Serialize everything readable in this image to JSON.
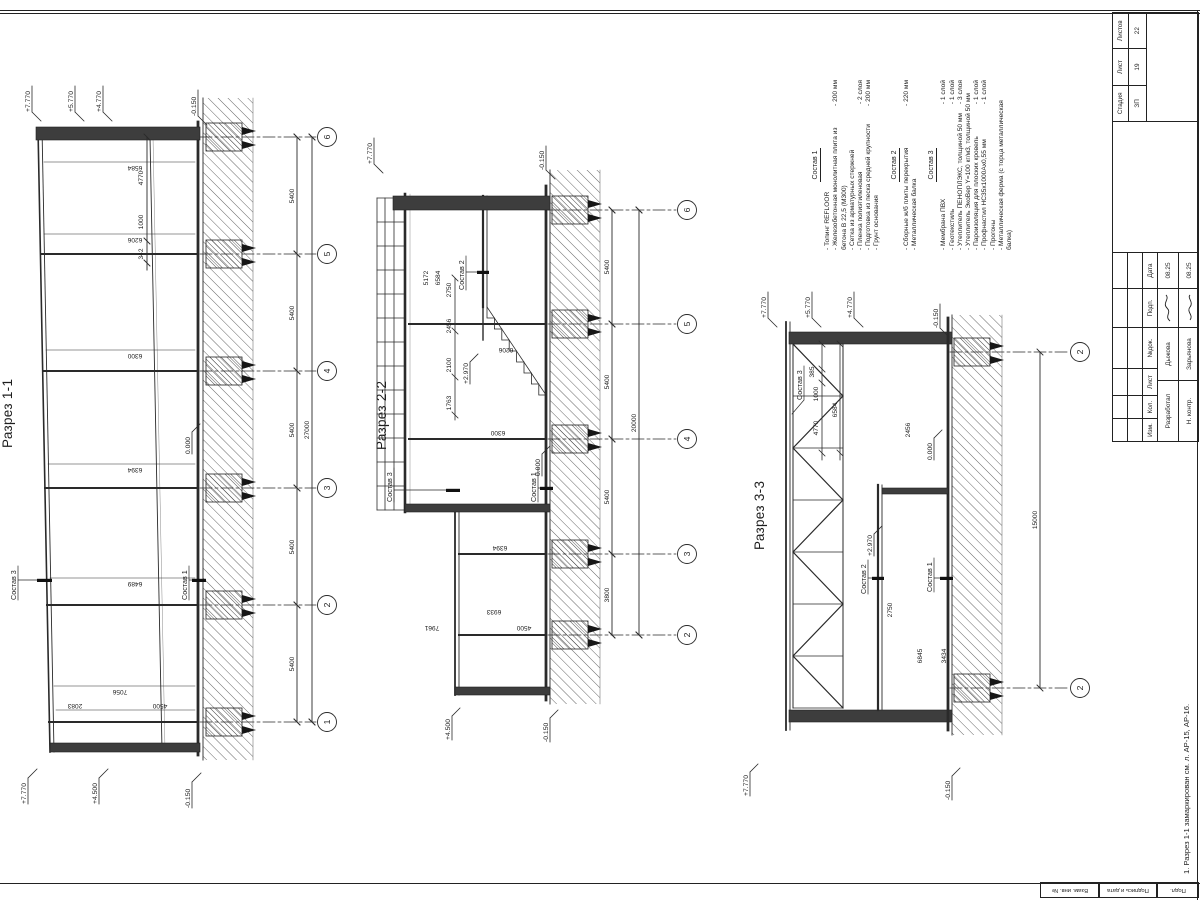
{
  "sections": {
    "s1": {
      "title": "Разрез 1-1",
      "axes": [
        "1",
        "2",
        "3",
        "4",
        "5",
        "6"
      ],
      "bay_dims": [
        "5400",
        "5400",
        "5400",
        "5400",
        "5400"
      ],
      "total_dim": "27000",
      "height_dims": [
        "2083",
        "4500",
        "7056",
        "6489",
        "6394",
        "6300",
        "6206",
        "6584"
      ],
      "top_dims": [
        "342",
        "1000",
        "4770"
      ],
      "elev": {
        "r1": "+7.770",
        "r2": "+5.770",
        "r3": "+4.770",
        "l1": "+7.770",
        "l2": "+4.500",
        "grade_r": "-0.150",
        "grade_l": "-0.150",
        "floor": "0.000"
      },
      "labels": {
        "roof": "Состав 3",
        "floor": "Состав 1"
      }
    },
    "s2": {
      "title": "Разрез 2-2",
      "axes": [
        "2",
        "3",
        "4",
        "5",
        "6"
      ],
      "bay_dims": [
        "3800",
        "5400",
        "5400",
        "5400"
      ],
      "total_dim": "20000",
      "stair_dims": [
        "1763",
        "2100",
        "2456",
        "2750"
      ],
      "upper_dims": [
        "5172",
        "6584"
      ],
      "vert_dims": [
        "7961",
        "6933",
        "4500",
        "6394",
        "6300",
        "6206"
      ],
      "elev": {
        "roof": "+7.770",
        "annex": "+4.500",
        "mezz": "+2.970",
        "floor": "0.000",
        "grade_r": "-0.150",
        "grade_l": "-0.150"
      },
      "labels": {
        "roof": "Состав 3",
        "mezz": "Состав 2",
        "floor": "Состав 1"
      }
    },
    "s3": {
      "title": "Разрез 3-3",
      "axes": [
        "2",
        "2"
      ],
      "total_dim": "15000",
      "top_dims": [
        "4770",
        "1000",
        "385"
      ],
      "top_total": "6584",
      "dims": {
        "mezz_h": "2750",
        "d2456": "2456",
        "d6845": "6845",
        "d3434": "3434"
      },
      "elev": {
        "r1": "+7.770",
        "r2": "+5.770",
        "r3": "+4.770",
        "l1": "+7.770",
        "mezz": "+2.970",
        "floor": "0.000",
        "grade_r": "-0.150",
        "grade_l": "-0.150"
      },
      "labels": {
        "roof": "Состав 3",
        "mezz": "Состав 2",
        "floor": "Состав 1"
      }
    }
  },
  "notes": {
    "groups": [
      {
        "header": "Состав 1",
        "items": [
          {
            "t": "- Топинг REFLOOR",
            "v": ""
          },
          {
            "t": "- Железобетонная монолитная плита из бетона В 22,5 (М300)",
            "v": "- 200 мм"
          },
          {
            "t": "- Сетка из арматурных стержней",
            "v": ""
          },
          {
            "t": "- Пленка полиэтиленовая",
            "v": "- 2 слоя"
          },
          {
            "t": "- Подготовка из песка средней крупности",
            "v": "- 200 мм"
          },
          {
            "t": "- Грунт основания",
            "v": ""
          }
        ]
      },
      {
        "header": "Состав 2",
        "items": [
          {
            "t": "- Сборные ж/б плиты перекрытия",
            "v": "- 220 мм"
          },
          {
            "t": "- Металлическая балка",
            "v": ""
          }
        ]
      },
      {
        "header": "Состав 3",
        "items": [
          {
            "t": "- Мембрана ПВХ",
            "v": "- 1 слой"
          },
          {
            "t": "- Геотекстиль",
            "v": "- 1 слой"
          },
          {
            "t": "- Утеплитель ПЕНОПЛЭКС, толщиной 50 мм",
            "v": "- 3 слоя"
          },
          {
            "t": "- Утеплитель ЭкоВер Y=100 кг/м3, толщиной 50 мм",
            "v": ""
          },
          {
            "t": "- Пароизоляция для плоских кровель",
            "v": "- 1 слой"
          },
          {
            "t": "- Профнастил НС35х1000Ах0,55 мм",
            "v": "- 1 слой"
          },
          {
            "t": "- Прогоны",
            "v": ""
          },
          {
            "t": "- Металлическая ферма (с торца металлическая балка)",
            "v": ""
          }
        ]
      }
    ]
  },
  "footnote": "1. Разрез 1-1 замаркирован см. л. АР-15, АР-16.",
  "titleblock": {
    "cols": [
      "Изм.",
      "Кол.",
      "Лист",
      "№док.",
      "Подп.",
      "Дата"
    ],
    "rows": [
      {
        "role": "Разработал",
        "name": "Дыжова",
        "date": "08.25"
      },
      {
        "role": "Н. контр.",
        "name": "Зарьянова",
        "date": "08.25"
      }
    ],
    "stage_label": "Стадия",
    "sheet_label": "Лист",
    "sheets_label": "Листов",
    "stage": "ЗП",
    "sheet_no": "19",
    "sheets_total": "22"
  },
  "margins": {
    "boxes": [
      "Взам. инв. №",
      "Подпись и дата",
      "Подл."
    ]
  }
}
